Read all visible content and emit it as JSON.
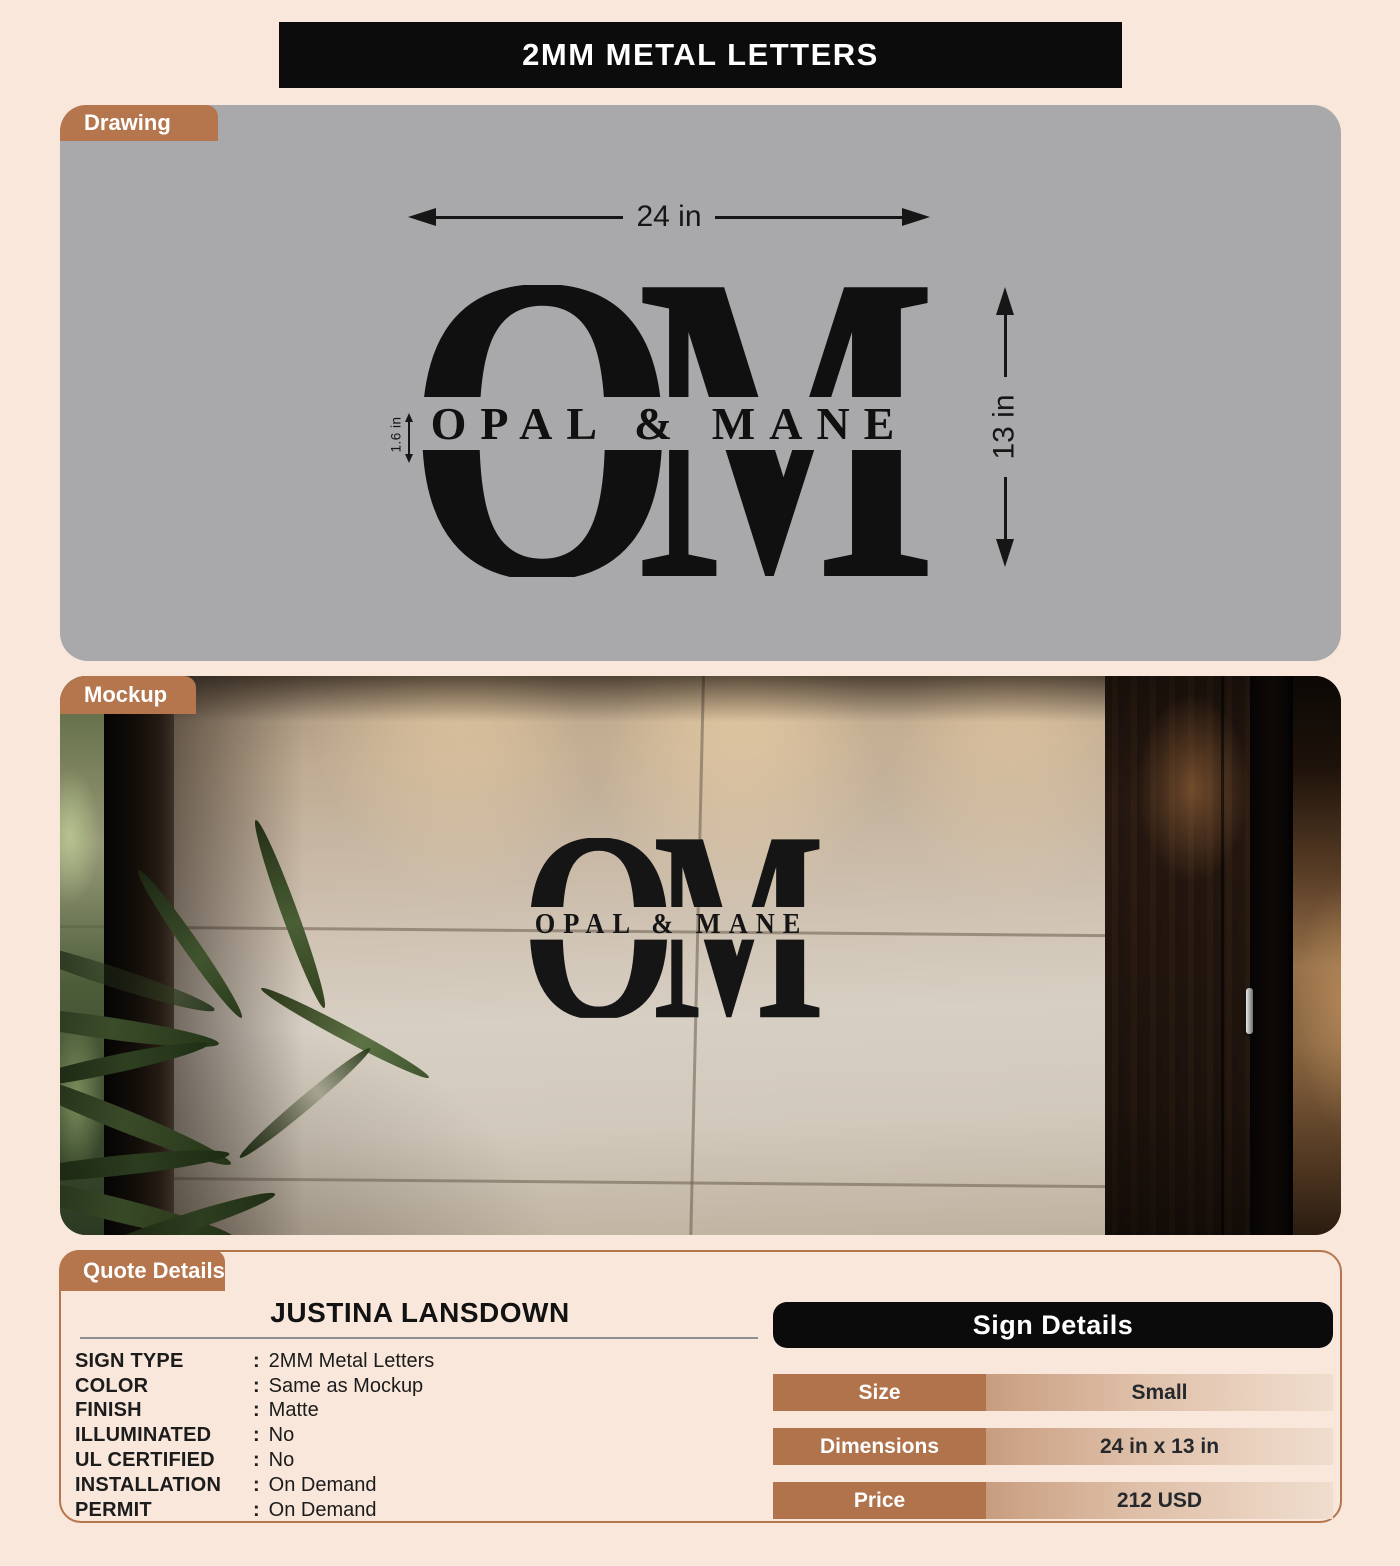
{
  "title": "2MM METAL LETTERS",
  "sections": {
    "drawing_label": "Drawing",
    "mockup_label": "Mockup",
    "quote_label": "Quote Details"
  },
  "logo": {
    "monogram_left": "O",
    "monogram_right": "M",
    "wordmark": "OPAL & MANE"
  },
  "drawing": {
    "width_dim": "24 in",
    "height_dim": "13 in",
    "letter_height_dim": "1.6 in"
  },
  "quote": {
    "customer_name": "JUSTINA LANSDOWN",
    "fields": [
      {
        "label": "SIGN TYPE",
        "colon": ":",
        "value": "2MM Metal Letters"
      },
      {
        "label": "COLOR",
        "colon": ":",
        "value": "Same as Mockup"
      },
      {
        "label": "FINISH",
        "colon": ":",
        "value": "Matte"
      },
      {
        "label": "ILLUMINATED",
        "colon": ":",
        "value": "No"
      },
      {
        "label": "UL CERTIFIED",
        "colon": ":",
        "value": "No"
      },
      {
        "label": "INSTALLATION",
        "colon": ":",
        "value": "On Demand"
      },
      {
        "label": "PERMIT",
        "colon": ":",
        "value": "On Demand"
      }
    ]
  },
  "sign_details": {
    "header": "Sign Details",
    "rows": [
      {
        "label": "Size",
        "value": "Small"
      },
      {
        "label": "Dimensions",
        "value": "24 in x 13 in"
      },
      {
        "label": "Price",
        "value": "212 USD"
      }
    ]
  },
  "colors": {
    "accent_copper": "#b5764e",
    "page_background": "#f8e7da",
    "drawing_panel_gray": "#a9a9ac",
    "banner_black": "#0c0c0c",
    "logo_black": "#101010"
  }
}
